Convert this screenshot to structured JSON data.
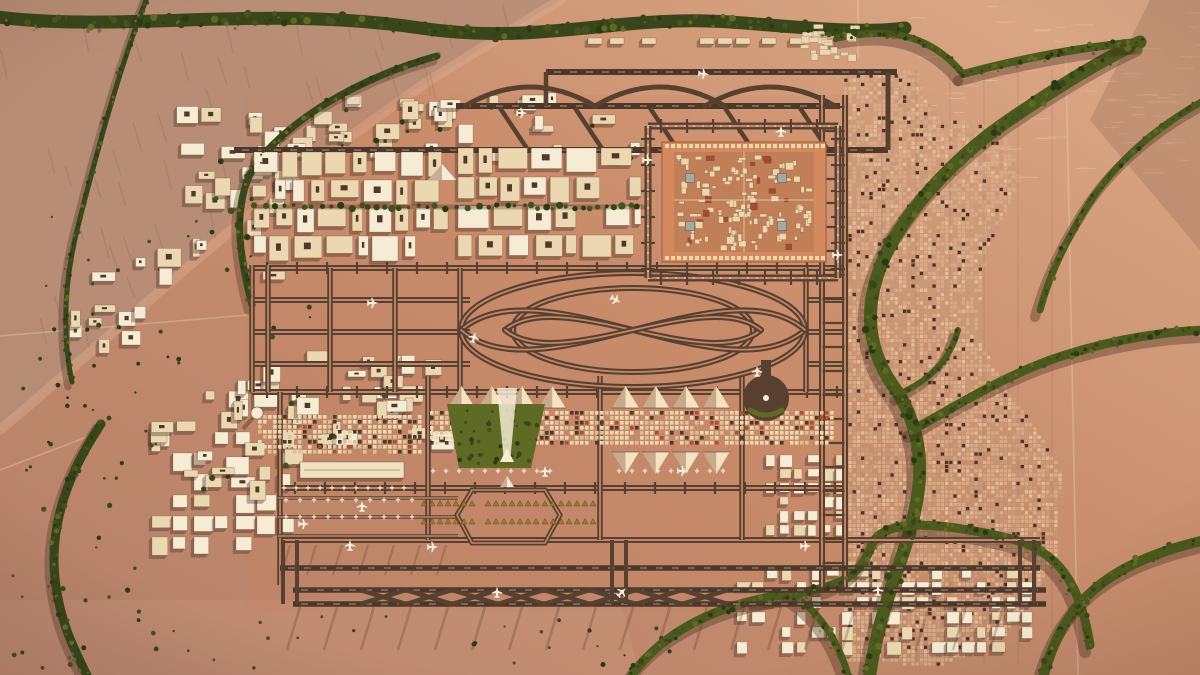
{
  "scene": {
    "kind": "aerial-desert-masterplan-render",
    "canvas": {
      "w": 1200,
      "h": 675
    }
  },
  "palette": {
    "sandTopRight": "#ddab89",
    "sandBase": "#c88e6d",
    "sandBottomLeft": "#b5816a",
    "duneFace": "#b68d77",
    "duneStreak": "#96725f",
    "duneRidgeLight": "#dcab8b",
    "rippleLight": "#ecc5a0",
    "airportTint": "rgba(205,125,90,0.14)",
    "taxiwayDark": "#57402f",
    "runwayDark": "#4c382a",
    "railCenter": "#c08668",
    "centerlineWhite": "rgba(238,223,202,0.55)",
    "buildingCream": "#ecd8b0",
    "buildingBright": "#f6ecd3",
    "buildingMid": "#dcc094",
    "buildingShadow": "rgba(72,45,34,0.38)",
    "courtDark": "#50382b",
    "palaceFrame": "#d28a5e",
    "palaceGround": "#c07f57",
    "palaceBlock": "#ecd6aa",
    "palaceRed": "#a84a30",
    "padGray": "#a9a9a1",
    "olive": "#4d5a1d",
    "oliveDark": "#39461a",
    "oliveDeep": "#2c3a14",
    "oliveLight": "#5f6b24",
    "goldTent": "#9c7a26",
    "planeWhite": "#f4ecdc",
    "tickWhite": "#e9dcc6",
    "roadFaint": "rgba(242,216,190,0.35)",
    "shadowStreak": "rgba(85,52,40,0.26)",
    "cityTileA": "#d7ab85",
    "cityTileB": "#c79a78",
    "cityTileC": "#e3bd96",
    "cityGap": "#4a332a"
  },
  "vegetation": {
    "top_band": {
      "path": "M-10,16 C 120,34 260,4 420,28 C 540,46 620,14 730,22 C 800,27 860,34 905,28",
      "width": 13
    },
    "lines": [
      {
        "path": "M437,56 C 372,74 300,110 259,160 C 231,196 238,252 252,305",
        "width": 7
      },
      {
        "path": "M148,-5 C 122,60 100,140 79,222 C 65,276 61,330 72,382",
        "width": 5
      },
      {
        "path": "M101,424 C 70,470 47,526 56,586 C 62,630 78,655 88,678",
        "width": 9
      }
    ],
    "desert_shrub_count": 90
  },
  "corridors": [
    {
      "path": "M869,680 C 880,600 906,560 916,505 C 926,455 914,420 899,394 C 871,358 862,318 879,271 C 895,222 952,158 1012,118 C 1062,84 1105,58 1140,42",
      "width": 13
    },
    {
      "path": "M913,430 C 962,402 1012,372 1062,356 C 1112,340 1158,332 1205,330",
      "width": 9
    },
    {
      "path": "M963,74 C 1015,60 1072,48 1138,42",
      "width": 8
    },
    {
      "path": "M837,38 C 880,30 925,28 963,74",
      "width": 7
    },
    {
      "path": "M630,678 C 668,622 738,600 790,594 C 842,588 862,574 872,544 C 884,520 930,520 1008,538 C 1058,550 1080,582 1090,645",
      "width": 9
    },
    {
      "path": "M791,594 C 820,612 838,640 849,678",
      "width": 7
    },
    {
      "path": "M1043,678 C 1062,606 1102,564 1205,540",
      "width": 10
    },
    {
      "path": "M1205,100 C 1150,130 1108,170 1082,215 C 1062,248 1048,280 1040,310",
      "width": 7
    },
    {
      "path": "M899,394 C 930,380 950,360 958,330",
      "width": 6
    }
  ],
  "east_city": {
    "boundary": [
      [
        843,
        78
      ],
      [
        912,
        70
      ],
      [
        938,
        118
      ],
      [
        1006,
        130
      ],
      [
        1022,
        182
      ],
      [
        987,
        252
      ],
      [
        977,
        332
      ],
      [
        1002,
        382
      ],
      [
        1032,
        422
      ],
      [
        1062,
        470
      ],
      [
        1056,
        560
      ],
      [
        1002,
        642
      ],
      [
        940,
        666
      ],
      [
        843,
        662
      ]
    ],
    "cell": 4.2,
    "density": 0.84
  },
  "bright_zones": [
    {
      "x": 737,
      "y": 567,
      "w": 300,
      "h": 92,
      "cell": 15,
      "density": 0.6
    },
    {
      "x": 766,
      "y": 455,
      "w": 86,
      "h": 80,
      "cell": 14,
      "density": 0.72
    },
    {
      "x": 152,
      "y": 432,
      "w": 132,
      "h": 122,
      "cell": 21,
      "density": 0.5
    }
  ],
  "west_clusters": [
    {
      "x": 158,
      "y": 92,
      "w": 490,
      "h": 58,
      "n": 44
    },
    {
      "x": 168,
      "y": 155,
      "w": 110,
      "h": 120,
      "n": 16
    },
    {
      "x": 60,
      "y": 244,
      "w": 105,
      "h": 100,
      "n": 12
    },
    {
      "x": 205,
      "y": 350,
      "w": 235,
      "h": 62,
      "n": 24
    },
    {
      "x": 148,
      "y": 396,
      "w": 165,
      "h": 85,
      "n": 15
    },
    {
      "x": 305,
      "y": 385,
      "w": 135,
      "h": 50,
      "n": 12
    }
  ],
  "districts": [
    {
      "x": 254,
      "y": 150,
      "w": 196,
      "h": 112,
      "rows": 4,
      "cols": 6
    },
    {
      "x": 458,
      "y": 146,
      "w": 185,
      "h": 116,
      "rows": 4,
      "cols": 5
    }
  ],
  "tree_median": {
    "y": 207,
    "x1": 254,
    "x2": 645
  },
  "dense_strips": [
    {
      "x": 430,
      "y": 411,
      "w": 408,
      "h": 37
    },
    {
      "x": 258,
      "y": 415,
      "w": 168,
      "h": 42
    }
  ],
  "tents_up": [
    {
      "x": 448,
      "y": 408,
      "n": 4,
      "s": 27
    },
    {
      "x": 612,
      "y": 408,
      "n": 4,
      "s": 27
    }
  ],
  "tents_down": [
    {
      "x": 612,
      "y": 452,
      "n": 4,
      "s": 27
    }
  ],
  "gold_tents": {
    "ys": [
      506,
      524
    ],
    "clusters": [
      424,
      488,
      545
    ],
    "n": 7,
    "step": 8
  },
  "plaza": {
    "cx": 766,
    "cy": 398,
    "r": 23
  },
  "terminal": {
    "x": 300,
    "y": 462,
    "w": 104,
    "h": 16
  },
  "dome": {
    "cx": 257,
    "cy": 413,
    "r": 6
  },
  "spire": {
    "x": 507,
    "y": 462
  },
  "park": [
    [
      447,
      404
    ],
    [
      545,
      404
    ],
    [
      531,
      468
    ],
    [
      459,
      468
    ]
  ],
  "runways_top": [
    {
      "y": 72,
      "x1": 546,
      "x2": 897
    },
    {
      "y": 106,
      "x1": 456,
      "x2": 840
    },
    {
      "y": 150,
      "x1": 234,
      "x2": 888
    }
  ],
  "runways_bottom": [
    {
      "y": 568,
      "x1": 280,
      "x2": 1040
    },
    {
      "y": 590,
      "x1": 293,
      "x2": 1046
    },
    {
      "y": 604,
      "x1": 293,
      "x2": 1046
    }
  ],
  "palace": {
    "ring": [
      648,
      126,
      190,
      152
    ],
    "frame": [
      662,
      142,
      164,
      120
    ],
    "inner": [
      674,
      152,
      140,
      100
    ],
    "pads": [
      [
        690,
        178
      ],
      [
        782,
        178
      ],
      [
        690,
        226
      ],
      [
        782,
        226
      ]
    ]
  },
  "planes": [
    [
      373,
      303,
      90
    ],
    [
      474,
      337,
      15
    ],
    [
      616,
      300,
      120
    ],
    [
      522,
      113,
      90
    ],
    [
      704,
      74,
      95
    ],
    [
      781,
      131,
      0
    ],
    [
      838,
      255,
      90
    ],
    [
      545,
      471,
      0
    ],
    [
      806,
      546,
      90
    ],
    [
      622,
      592,
      45
    ],
    [
      497,
      592,
      0
    ],
    [
      433,
      547,
      90
    ],
    [
      878,
      590,
      0
    ],
    [
      304,
      524,
      90
    ],
    [
      362,
      506,
      0
    ],
    [
      683,
      471,
      90
    ],
    [
      757,
      371,
      0
    ],
    [
      648,
      160,
      90
    ],
    [
      350,
      545,
      0
    ]
  ],
  "apron_rows": [
    {
      "x0": 286,
      "x1": 420,
      "y": 500,
      "step": 14
    },
    {
      "x0": 286,
      "x1": 420,
      "y": 517,
      "step": 14
    },
    {
      "x0": 433,
      "x1": 562,
      "y": 471,
      "step": 13
    },
    {
      "x0": 619,
      "x1": 728,
      "y": 471,
      "step": 13
    },
    {
      "x0": 284,
      "x1": 404,
      "y": 488,
      "step": 12
    }
  ],
  "top_structures": {
    "y": 38,
    "xs": [
      588,
      610,
      642,
      700,
      718,
      736,
      762,
      790
    ],
    "dense": {
      "x": 800,
      "y": 24,
      "w": 52,
      "h": 34
    }
  },
  "roads_faint": [
    {
      "x1": 0,
      "y1": 336,
      "x2": 248,
      "y2": 315
    },
    {
      "x1": 0,
      "y1": 470,
      "x2": 100,
      "y2": 432
    },
    {
      "x1": 1066,
      "y1": 60,
      "x2": 1078,
      "y2": 675
    },
    {
      "x1": 858,
      "y1": 0,
      "x2": 858,
      "y2": 58
    }
  ]
}
